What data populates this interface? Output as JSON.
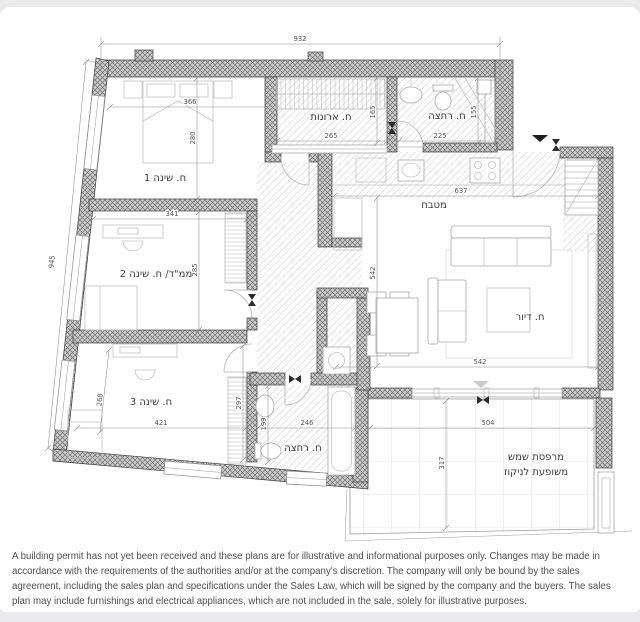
{
  "disclaimer": "A building permit has not yet been received and these plans are for illustrative and informational purposes only. Changes may be made in accordance with the requirements of the authorities and/or at the company's discretion. The company will only be bound by the sales agreement, including the sales plan and specifications under the Sales Law, which will be signed by the company and the buyers. The sales plan may include furnishings and electrical appliances, which are not included in the sale, solely for illustrative purposes.",
  "plan": {
    "room_labels": [
      {
        "id": "bedroom-1",
        "text": "ח. שינה 1",
        "x": 165,
        "y": 181
      },
      {
        "id": "safe-room-bedroom-2",
        "text": "ממ\"ד/ ח. שינה 2",
        "x": 156,
        "y": 277
      },
      {
        "id": "bedroom-3",
        "text": "ח. שינה 3",
        "x": 151,
        "y": 405
      },
      {
        "id": "closet-room",
        "text": "ח. ארונות",
        "x": 331,
        "y": 120
      },
      {
        "id": "bathroom-1",
        "text": "ח. רחצה",
        "x": 447,
        "y": 119
      },
      {
        "id": "kitchen",
        "text": "מטבח",
        "x": 434,
        "y": 208
      },
      {
        "id": "living-room",
        "text": "ח. דיור",
        "x": 530,
        "y": 320
      },
      {
        "id": "bathroom-2",
        "text": "ח. רחצה",
        "x": 303,
        "y": 451
      },
      {
        "id": "balcony-line1",
        "text": "מרפסת שמש",
        "x": 536,
        "y": 460
      },
      {
        "id": "balcony-line2",
        "text": "משופעת לניקוז",
        "x": 536,
        "y": 475
      }
    ],
    "dimensions": [
      {
        "label": "932",
        "x1": 101,
        "y1": 44,
        "x2": 500,
        "y2": 44,
        "lx": 300,
        "ly": 41,
        "rot": 0
      },
      {
        "label": "945",
        "x1": 86,
        "y1": 62,
        "x2": 48,
        "y2": 448,
        "lx": 54,
        "ly": 262,
        "rot": -84
      },
      {
        "label": "366",
        "x1": 110,
        "y1": 107,
        "x2": 268,
        "y2": 107,
        "lx": 190,
        "ly": 104,
        "rot": 0
      },
      {
        "label": "280",
        "x1": 197,
        "y1": 78,
        "x2": 197,
        "y2": 199,
        "lx": 195,
        "ly": 138,
        "rot": -90
      },
      {
        "label": "341",
        "x1": 93,
        "y1": 219,
        "x2": 247,
        "y2": 219,
        "lx": 172,
        "ly": 216,
        "rot": 0
      },
      {
        "label": "285",
        "x1": 199,
        "y1": 212,
        "x2": 199,
        "y2": 330,
        "lx": 197,
        "ly": 270,
        "rot": -90
      },
      {
        "label": "268",
        "x1": 109,
        "y1": 350,
        "x2": 100,
        "y2": 432,
        "lx": 102,
        "ly": 400,
        "rot": -84
      },
      {
        "label": "421",
        "x1": 77,
        "y1": 428,
        "x2": 246,
        "y2": 428,
        "lx": 161,
        "ly": 425,
        "rot": 0
      },
      {
        "label": "297",
        "x1": 243,
        "y1": 346,
        "x2": 243,
        "y2": 460,
        "lx": 241,
        "ly": 403,
        "rot": -90
      },
      {
        "label": "199",
        "x1": 268,
        "y1": 386,
        "x2": 268,
        "y2": 462,
        "lx": 266,
        "ly": 424,
        "rot": -90
      },
      {
        "label": "246",
        "x1": 258,
        "y1": 428,
        "x2": 355,
        "y2": 428,
        "lx": 307,
        "ly": 425,
        "rot": 0
      },
      {
        "label": "265",
        "x1": 277,
        "y1": 141,
        "x2": 387,
        "y2": 141,
        "lx": 331,
        "ly": 138,
        "rot": 0
      },
      {
        "label": "165",
        "x1": 377,
        "y1": 78,
        "x2": 377,
        "y2": 143,
        "lx": 375,
        "ly": 112,
        "rot": -90
      },
      {
        "label": "225",
        "x1": 399,
        "y1": 141,
        "x2": 495,
        "y2": 141,
        "lx": 440,
        "ly": 138,
        "rot": 0
      },
      {
        "label": "155",
        "x1": 478,
        "y1": 78,
        "x2": 478,
        "y2": 143,
        "lx": 476,
        "ly": 112,
        "rot": -90
      },
      {
        "label": "637",
        "x1": 334,
        "y1": 196,
        "x2": 598,
        "y2": 196,
        "lx": 461,
        "ly": 193,
        "rot": 0
      },
      {
        "label": "542",
        "x1": 377,
        "y1": 198,
        "x2": 377,
        "y2": 366,
        "lx": 375,
        "ly": 273,
        "rot": -90
      },
      {
        "label": "542",
        "x1": 336,
        "y1": 367,
        "x2": 598,
        "y2": 367,
        "lx": 480,
        "ly": 364,
        "rot": 0
      },
      {
        "label": "504",
        "x1": 370,
        "y1": 428,
        "x2": 594,
        "y2": 428,
        "lx": 488,
        "ly": 425,
        "rot": 0
      },
      {
        "label": "317",
        "x1": 446,
        "y1": 401,
        "x2": 446,
        "y2": 528,
        "lx": 444,
        "ly": 463,
        "rot": -90
      }
    ],
    "markers": [
      {
        "name": "entrance-arrow-icon",
        "type": "triangle",
        "x": 540,
        "y": 135,
        "fill": "#1f1f1f"
      },
      {
        "name": "level-change-arrow-icon",
        "type": "triangle",
        "x": 481,
        "y": 381,
        "fill": "#c9c9c9"
      },
      {
        "name": "door-bowtie-icon",
        "type": "bowtie",
        "x": 556,
        "y": 145,
        "rot": 0
      },
      {
        "name": "door-bowtie-icon",
        "type": "bowtie",
        "x": 392,
        "y": 128,
        "rot": 0
      },
      {
        "name": "door-bowtie-icon",
        "type": "bowtie",
        "x": 252,
        "y": 300,
        "rot": 0
      },
      {
        "name": "door-bowtie-icon",
        "type": "bowtie",
        "x": 295,
        "y": 379,
        "rot": 90
      },
      {
        "name": "door-bowtie-icon",
        "type": "bowtie",
        "x": 483,
        "y": 400,
        "rot": 90
      }
    ],
    "colors": {
      "page_bg": "#ebebed",
      "card_bg": "#ffffff",
      "wall_fill": "#cdcdcd",
      "wall_hatch": "#6e6e6e",
      "wall_outline": "#3e3e3e",
      "floor_hatch": "#dedede",
      "furniture": "#c2c2c2",
      "dim_text": "#55555a",
      "label_text": "#3a3a3a",
      "disclaimer_text": "#4e4e52"
    }
  }
}
